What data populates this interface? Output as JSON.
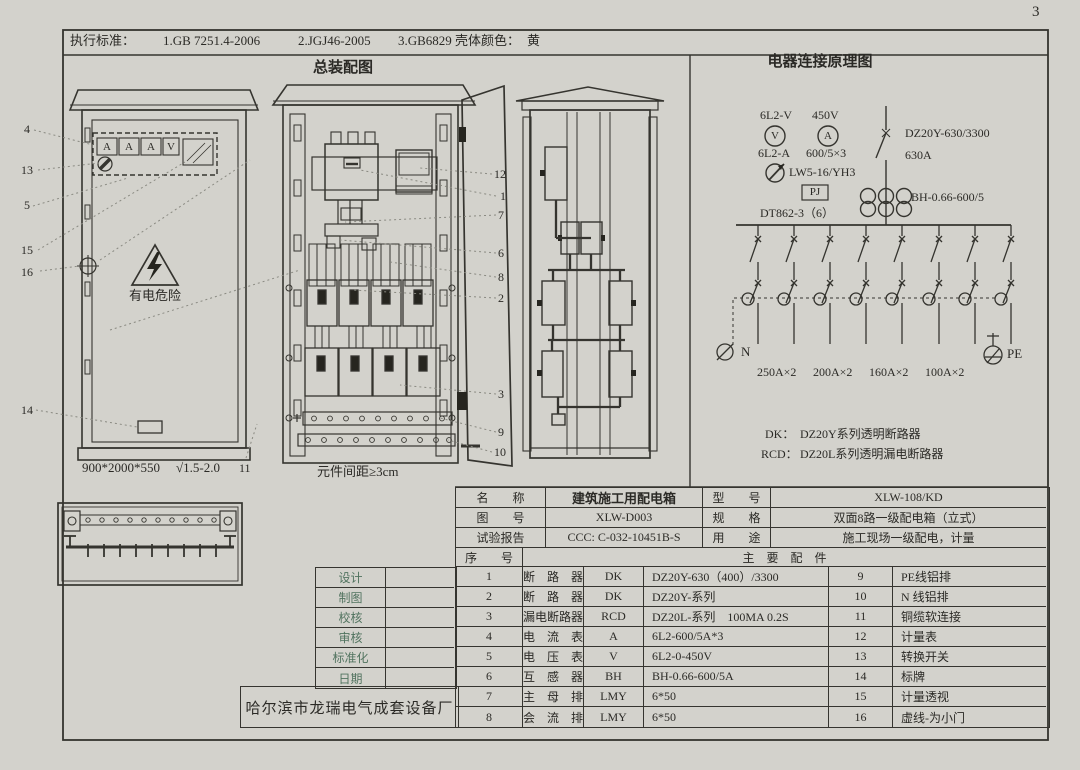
{
  "page": {
    "number": "3"
  },
  "header": {
    "exec_label": "执行标准：",
    "standard_1": "1.GB 7251.4-2006",
    "standard_2": "2.JGJ46-2005",
    "standard_3": "3.GB6829",
    "shell_color_label": "壳体颜色：",
    "shell_color_value": "黄"
  },
  "assembly": {
    "title": "总装配图",
    "front": {
      "meters": [
        "A",
        "A",
        "A",
        "V"
      ],
      "warning": "有电危险",
      "size": "900*2000*550",
      "finish": "√1.5-2.0"
    },
    "spacing_note": "元件间距≥3cm",
    "callouts": {
      "c4": "4",
      "c13": "13",
      "c5": "5",
      "c15": "15",
      "c16": "16",
      "c14": "14",
      "c11": "11",
      "c12": "12",
      "c1": "1",
      "c7": "7",
      "c6": "6",
      "c8": "8",
      "c2": "2",
      "c3": "3",
      "c9": "9",
      "c10": "10"
    }
  },
  "schematic": {
    "title": "电器连接原理图",
    "voltmeter_model": "6L2-V",
    "voltage": "450V",
    "voltmeter_symbol": "V",
    "ammeter_symbol": "A",
    "ammeter_model": "6L2-A",
    "ct_ratio": "600/5×3",
    "main_breaker_model": "DZ20Y-630/3300",
    "main_breaker_current": "630A",
    "switch_model": "LW5-16/YH3",
    "meter_box": "PJ",
    "energy_meter": "DT862-3（6）",
    "ct_model": "BH-0.66-600/5",
    "neutral_label": "N",
    "earth_label": "PE",
    "branch_ratings": [
      "250A×2",
      "200A×2",
      "160A×2",
      "100A×2"
    ],
    "note_dk_key": "DK：",
    "note_dk_value": "DZ20Y系列透明断路器",
    "note_rcd_key": "RCD：",
    "note_rcd_value": "DZ20L系列透明漏电断路器"
  },
  "title_block": {
    "name_label": "名　　称",
    "name_value": "建筑施工用配电箱",
    "model_label": "型　　号",
    "model_value": "XLW-108/KD",
    "drawing_label": "图　　号",
    "drawing_value": "XLW-D003",
    "spec_label": "规　　格",
    "spec_value": "双面8路一级配电箱（立式）",
    "report_label": "试验报告",
    "report_value": "CCC: C-032-10451B-S",
    "use_label": "用　　途",
    "use_value": "施工现场一级配电，计量",
    "serial_label": "序　　号",
    "parts_label": "主　要　配　件"
  },
  "parts": [
    {
      "no": "1",
      "name": "断　路　器",
      "code": "DK",
      "spec": "DZ20Y-630（400）/3300",
      "no2": "9",
      "name2": "PE线铝排"
    },
    {
      "no": "2",
      "name": "断　路　器",
      "code": "DK",
      "spec": "DZ20Y-系列",
      "no2": "10",
      "name2": "N 线铝排"
    },
    {
      "no": "3",
      "name": "漏电断路器",
      "code": "RCD",
      "spec": "DZ20L-系列　100MA 0.2S",
      "no2": "11",
      "name2": "铜缆软连接"
    },
    {
      "no": "4",
      "name": "电　流　表",
      "code": "A",
      "spec": "6L2-600/5A*3",
      "no2": "12",
      "name2": "计量表"
    },
    {
      "no": "5",
      "name": "电　压　表",
      "code": "V",
      "spec": "6L2-0-450V",
      "no2": "13",
      "name2": "转换开关"
    },
    {
      "no": "6",
      "name": "互　感　器",
      "code": "BH",
      "spec": "BH-0.66-600/5A",
      "no2": "14",
      "name2": "标牌"
    },
    {
      "no": "7",
      "name": "主　母　排",
      "code": "LMY",
      "spec": "6*50",
      "no2": "15",
      "name2": "计量透视"
    },
    {
      "no": "8",
      "name": "会　流　排",
      "code": "LMY",
      "spec": "6*50",
      "no2": "16",
      "name2": "虚线-为小门"
    }
  ],
  "signatures": [
    "设计",
    "制图",
    "校核",
    "审核",
    "标准化",
    "日期"
  ],
  "manufacturer": "哈尔滨市龙瑞电气成套设备厂"
}
